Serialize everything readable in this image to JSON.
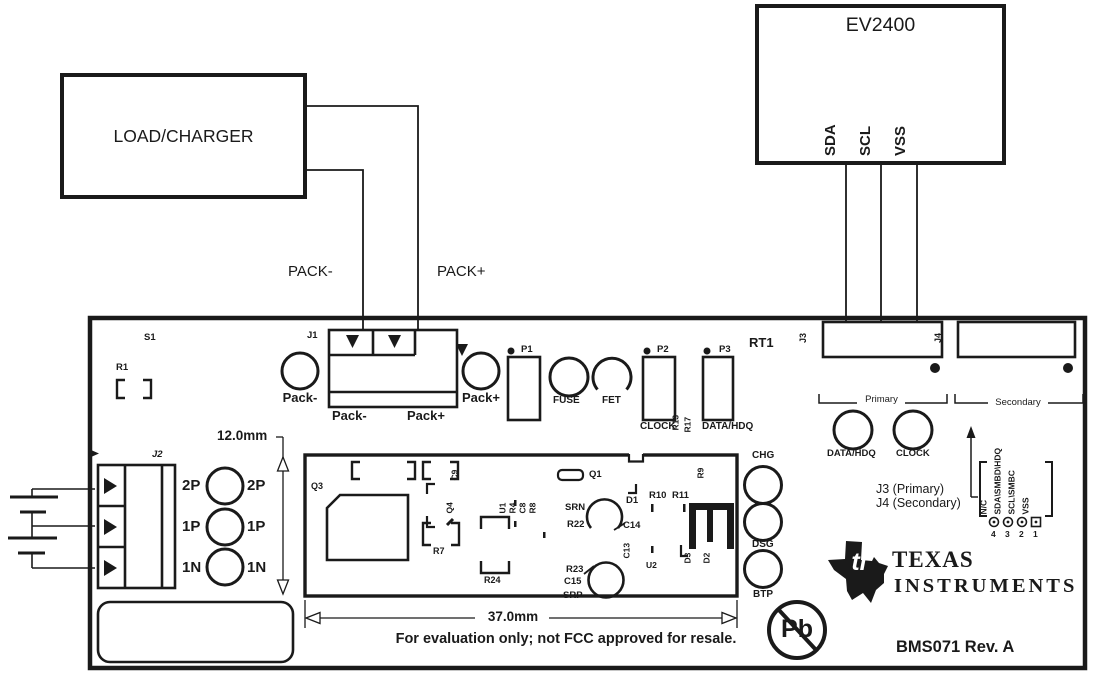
{
  "ev2400": {
    "title": "EV2400",
    "pins": [
      "SDA",
      "SCL",
      "VSS"
    ]
  },
  "load_charger": {
    "title": "LOAD/CHARGER"
  },
  "pack_wires": {
    "minus": "PACK-",
    "plus": "PACK+"
  },
  "board": {
    "refs": {
      "s1": "S1",
      "r1": "R1",
      "j1": "J1",
      "j2": "J2",
      "rt1": "RT1",
      "j3": "J3",
      "j4": "J4",
      "p1": "P1",
      "p2": "P2",
      "p3": "P3",
      "pack_minus": "Pack-",
      "pack_plus": "Pack+",
      "fuse": "FUSE",
      "fet": "FET",
      "clock": "CLOCK",
      "data_hdq": "DATA/HDQ",
      "r13": "R13",
      "r17": "R17",
      "q1": "Q1",
      "q3": "Q3",
      "q4": "Q4",
      "c9": "C9",
      "r7": "R7",
      "r24": "R24",
      "u1": "U1",
      "r4": "R4",
      "c8": "C8",
      "r8": "R8",
      "srn": "SRN",
      "r22": "R22",
      "c14": "C14",
      "d1": "D1",
      "r10": "R10",
      "r11": "R11",
      "c13": "C13",
      "u2": "U2",
      "r9": "R9",
      "d3": "D3",
      "d2": "D2",
      "r23": "R23",
      "c15": "C15",
      "srp": "SRP",
      "chg": "CHG",
      "dsg": "DSG",
      "btp": "BTP"
    },
    "rows": {
      "p2": "2P",
      "p1": "1P",
      "n1": "1N"
    },
    "groups": {
      "primary": "Primary",
      "secondary": "Secondary",
      "primary_data_hdq": "DATA/HDQ",
      "primary_clock": "CLOCK",
      "j3_primary": "J3 (Primary)",
      "j4_secondary": "J4 (Secondary)"
    },
    "pins": {
      "labels": [
        "N/C",
        "SDA\\SMBD\\HDQ",
        "SCL\\SMBC",
        "VSS"
      ],
      "numbers": [
        "4",
        "3",
        "2",
        "1"
      ]
    },
    "dimensions": {
      "height": "12.0mm",
      "width": "37.0mm"
    },
    "branding": {
      "ti_mark": "ti",
      "ti_name_line1": "TEXAS",
      "ti_name_line2": "INSTRUMENTS",
      "pb": "Pb",
      "rev": "BMS071 Rev. A",
      "disclaimer": "For evaluation only; not FCC approved for resale."
    }
  },
  "colors": {
    "ink": "#1a1a1a",
    "background": "#ffffff"
  }
}
